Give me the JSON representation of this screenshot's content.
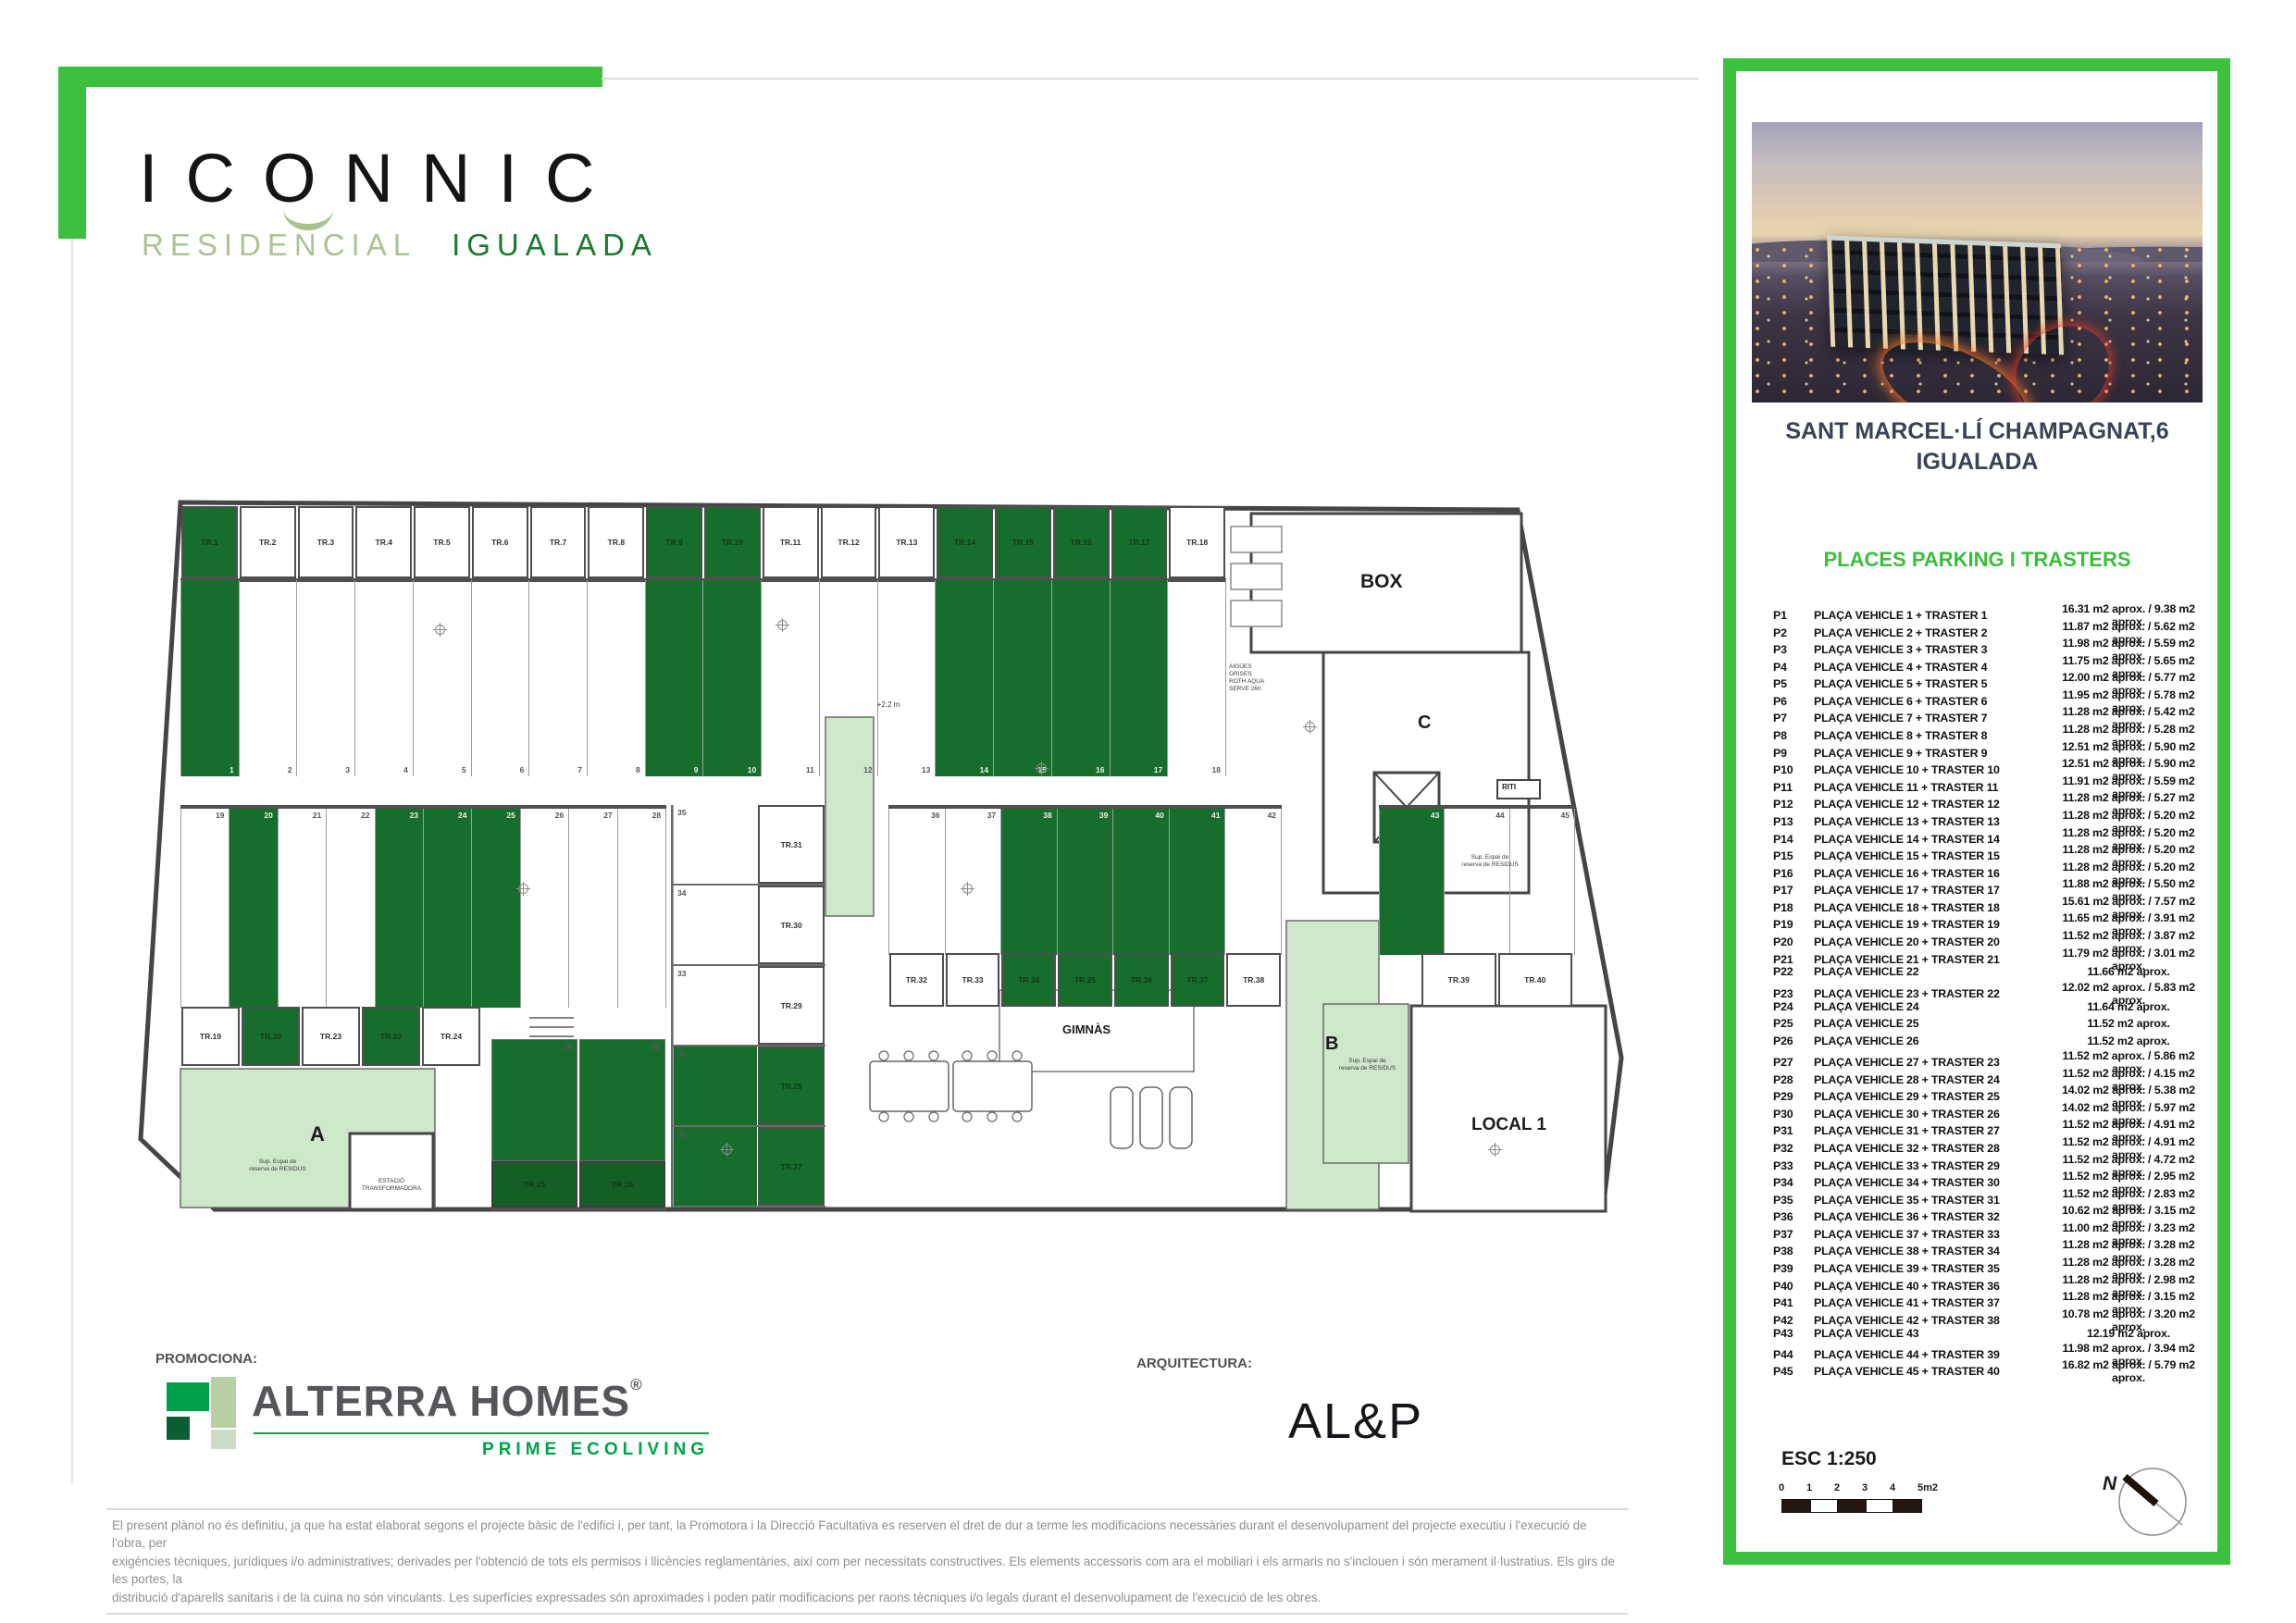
{
  "brand": {
    "name": "ICONNIC",
    "tagline_left": "RESIDENCIAL",
    "tagline_right": "IGUALADA"
  },
  "promoter": {
    "label": "PROMOCIONA:",
    "name": "ALTERRA HOMES",
    "reg": "®",
    "tagline": "PRIME ECOLIVING"
  },
  "architect": {
    "label": "ARQUITECTURA:",
    "name": "AL&P"
  },
  "panel": {
    "address_line1": "SANT MARCEL·LÍ CHAMPAGNAT,6",
    "address_line2": "IGUALADA",
    "list_title": "PLACES PARKING I TRASTERS",
    "scale_label": "ESC 1:250",
    "scale_ticks": [
      "0",
      "1",
      "2",
      "3",
      "4",
      "5m2"
    ],
    "north_label": "N",
    "spots": [
      {
        "ref": "P1",
        "desc": "PLAÇA VEHICLE 1 + TRASTER 1",
        "area": "16.31 m2 aprox. / 9.38 m2 aprox."
      },
      {
        "ref": "P2",
        "desc": "PLAÇA VEHICLE 2 + TRASTER 2",
        "area": "11.87 m2 aprox. / 5.62 m2 aprox."
      },
      {
        "ref": "P3",
        "desc": "PLAÇA VEHICLE 3 + TRASTER 3",
        "area": "11.98 m2 aprox. / 5.59 m2 aprox."
      },
      {
        "ref": "P4",
        "desc": "PLAÇA VEHICLE 4 + TRASTER 4",
        "area": "11.75 m2 aprox. / 5.65 m2 aprox."
      },
      {
        "ref": "P5",
        "desc": "PLAÇA VEHICLE 5 + TRASTER 5",
        "area": "12.00 m2 aprox. / 5.77 m2 aprox."
      },
      {
        "ref": "P6",
        "desc": "PLAÇA VEHICLE 6 + TRASTER 6",
        "area": "11.95 m2 aprox. / 5.78 m2 aprox."
      },
      {
        "ref": "P7",
        "desc": "PLAÇA VEHICLE 7 + TRASTER 7",
        "area": "11.28 m2 aprox. / 5.42 m2 aprox."
      },
      {
        "ref": "P8",
        "desc": "PLAÇA VEHICLE 8 + TRASTER 8",
        "area": "11.28 m2 aprox. / 5.28 m2 aprox."
      },
      {
        "ref": "P9",
        "desc": "PLAÇA VEHICLE 9 + TRASTER 9",
        "area": "12.51 m2 aprox. / 5.90 m2 aprox."
      },
      {
        "ref": "P10",
        "desc": "PLAÇA VEHICLE 10 + TRASTER 10",
        "area": "12.51 m2 aprox. / 5.90 m2 aprox."
      },
      {
        "ref": "P11",
        "desc": "PLAÇA VEHICLE 11 + TRASTER 11",
        "area": "11.91 m2 aprox. / 5.59 m2 aprox."
      },
      {
        "ref": "P12",
        "desc": "PLAÇA VEHICLE 12 + TRASTER 12",
        "area": "11.28 m2 aprox. / 5.27 m2 aprox."
      },
      {
        "ref": "P13",
        "desc": "PLAÇA VEHICLE 13 + TRASTER 13",
        "area": "11.28 m2 aprox. / 5.20 m2 aprox."
      },
      {
        "ref": "P14",
        "desc": "PLAÇA VEHICLE 14 + TRASTER 14",
        "area": "11.28 m2 aprox. / 5.20 m2 aprox."
      },
      {
        "ref": "P15",
        "desc": "PLAÇA VEHICLE 15 + TRASTER 15",
        "area": "11.28 m2 aprox. / 5.20 m2 aprox."
      },
      {
        "ref": "P16",
        "desc": "PLAÇA VEHICLE 16 + TRASTER 16",
        "area": "11.28 m2 aprox. / 5.20 m2 aprox."
      },
      {
        "ref": "P17",
        "desc": "PLAÇA VEHICLE 17 + TRASTER 17",
        "area": "11.88 m2 aprox. / 5.50 m2 aprox."
      },
      {
        "ref": "P18",
        "desc": "PLAÇA VEHICLE 18 + TRASTER 18",
        "area": "15.61 m2 aprox. / 7.57 m2 aprox."
      },
      {
        "ref": "P19",
        "desc": "PLAÇA VEHICLE 19 + TRASTER 19",
        "area": "11.65 m2 aprox. / 3.91 m2 aprox."
      },
      {
        "ref": "P20",
        "desc": "PLAÇA VEHICLE 20 + TRASTER 20",
        "area": "11.52 m2 aprox. / 3.87 m2 aprox."
      },
      {
        "ref": "P21",
        "desc": "PLAÇA VEHICLE 21 + TRASTER 21",
        "area": "11.79 m2 aprox. / 3.01 m2 aprox."
      },
      {
        "ref": "P22",
        "desc": "PLAÇA VEHICLE 22",
        "area": "11.66 m2 aprox."
      },
      {
        "ref": "P23",
        "desc": "PLAÇA VEHICLE 23 + TRASTER 22",
        "area": "12.02 m2 aprox. / 5.83 m2 aprox."
      },
      {
        "ref": "P24",
        "desc": "PLAÇA VEHICLE 24",
        "area": "11.64 m2 aprox."
      },
      {
        "ref": "P25",
        "desc": "PLAÇA VEHICLE 25",
        "area": "11.52 m2 aprox."
      },
      {
        "ref": "P26",
        "desc": "PLAÇA VEHICLE 26",
        "area": "11.52 m2 aprox."
      },
      {
        "ref": "P27",
        "desc": "PLAÇA VEHICLE 27 + TRASTER 23",
        "area": "11.52 m2 aprox. / 5.86 m2 aprox."
      },
      {
        "ref": "P28",
        "desc": "PLAÇA VEHICLE 28 + TRASTER 24",
        "area": "11.52 m2 aprox. / 4.15 m2 aprox."
      },
      {
        "ref": "P29",
        "desc": "PLAÇA VEHICLE 29 + TRASTER 25",
        "area": "14.02 m2 aprox. / 5.38 m2 aprox."
      },
      {
        "ref": "P30",
        "desc": "PLAÇA VEHICLE 30 + TRASTER 26",
        "area": "14.02 m2 aprox. / 5.97 m2 aprox."
      },
      {
        "ref": "P31",
        "desc": "PLAÇA VEHICLE 31 + TRASTER 27",
        "area": "11.52 m2 aprox. / 4.91 m2 aprox."
      },
      {
        "ref": "P32",
        "desc": "PLAÇA VEHICLE 32 + TRASTER 28",
        "area": "11.52 m2 aprox. / 4.91 m2 aprox."
      },
      {
        "ref": "P33",
        "desc": "PLAÇA VEHICLE 33 + TRASTER 29",
        "area": "11.52 m2 aprox. / 4.72 m2 aprox."
      },
      {
        "ref": "P34",
        "desc": "PLAÇA VEHICLE 34 + TRASTER 30",
        "area": "11.52 m2 aprox. / 2.95 m2 aprox."
      },
      {
        "ref": "P35",
        "desc": "PLAÇA VEHICLE 35 + TRASTER 31",
        "area": "11.52 m2 aprox. / 2.83 m2 aprox."
      },
      {
        "ref": "P36",
        "desc": "PLAÇA VEHICLE 36 + TRASTER 32",
        "area": "10.62 m2 aprox. / 3.15 m2 aprox."
      },
      {
        "ref": "P37",
        "desc": "PLAÇA VEHICLE 37 + TRASTER 33",
        "area": "11.00 m2 aprox. / 3.23 m2 aprox."
      },
      {
        "ref": "P38",
        "desc": "PLAÇA VEHICLE 38 + TRASTER 34",
        "area": "11.28 m2 aprox. / 3.28 m2 aprox."
      },
      {
        "ref": "P39",
        "desc": "PLAÇA VEHICLE 39 + TRASTER 35",
        "area": "11.28 m2 aprox. / 3.28 m2 aprox."
      },
      {
        "ref": "P40",
        "desc": "PLAÇA VEHICLE 40 + TRASTER 36",
        "area": "11.28 m2 aprox. / 2.98 m2 aprox."
      },
      {
        "ref": "P41",
        "desc": "PLAÇA VEHICLE 41 + TRASTER 37",
        "area": "11.28 m2 aprox. / 3.15 m2 aprox."
      },
      {
        "ref": "P42",
        "desc": "PLAÇA VEHICLE 42 + TRASTER 38",
        "area": "10.78 m2 aprox. / 3.20 m2 aprox."
      },
      {
        "ref": "P43",
        "desc": "PLAÇA VEHICLE 43",
        "area": "12.19 m2 aprox."
      },
      {
        "ref": "P44",
        "desc": "PLAÇA VEHICLE 44 + TRASTER 39",
        "area": "11.98 m2 aprox. / 3.94 m2 aprox."
      },
      {
        "ref": "P45",
        "desc": "PLAÇA VEHICLE 45 + TRASTER 40",
        "area": "16.82 m2 aprox. / 5.79 m2 aprox."
      }
    ]
  },
  "plan": {
    "rooms": {
      "box": "BOX",
      "gimnas": "GIMNÀS",
      "local": "LOCAL 1",
      "core_a": "A",
      "core_b": "B",
      "core_c": "C",
      "riti": "RITI",
      "estacio": "ESTACIÓ\nTRANSFORMADORA",
      "ramp": "+2.2 m",
      "aigues": "AIGÜES\nGRISES\nROTH AQUA\nSERVE 260",
      "reserva_a": "Sup. Espai de\nreserva de RESIDUS",
      "reserva_b": "Sup. Espai de\nreserva de RESIDUS",
      "reserva_c": "Sup. Espai de\nreserva de RESIDUS"
    },
    "trasters_top": [
      {
        "label": "TR.1",
        "state": "sold"
      },
      {
        "label": "TR.2",
        "state": "free"
      },
      {
        "label": "TR.3",
        "state": "free"
      },
      {
        "label": "TR.4",
        "state": "free"
      },
      {
        "label": "TR.5",
        "state": "free"
      },
      {
        "label": "TR.6",
        "state": "free"
      },
      {
        "label": "TR.7",
        "state": "free"
      },
      {
        "label": "TR.8",
        "state": "free"
      },
      {
        "label": "TR.9",
        "state": "sold"
      },
      {
        "label": "TR.10",
        "state": "sold"
      },
      {
        "label": "TR.11",
        "state": "free"
      },
      {
        "label": "TR.12",
        "state": "free"
      },
      {
        "label": "TR.13",
        "state": "free"
      },
      {
        "label": "TR.14",
        "state": "sold"
      },
      {
        "label": "TR.15",
        "state": "sold"
      },
      {
        "label": "TR.16",
        "state": "sold"
      },
      {
        "label": "TR.17",
        "state": "sold"
      },
      {
        "label": "TR.18",
        "state": "free"
      }
    ],
    "stalls_top": [
      {
        "num": "1",
        "state": "sold"
      },
      {
        "num": "2",
        "state": "free"
      },
      {
        "num": "3",
        "state": "free"
      },
      {
        "num": "4",
        "state": "free"
      },
      {
        "num": "5",
        "state": "free"
      },
      {
        "num": "6",
        "state": "free"
      },
      {
        "num": "7",
        "state": "free"
      },
      {
        "num": "8",
        "state": "free"
      },
      {
        "num": "9",
        "state": "sold"
      },
      {
        "num": "10",
        "state": "sold"
      },
      {
        "num": "11",
        "state": "free"
      },
      {
        "num": "12",
        "state": "free"
      },
      {
        "num": "13",
        "state": "free"
      },
      {
        "num": "14",
        "state": "sold"
      },
      {
        "num": "15",
        "state": "sold"
      },
      {
        "num": "16",
        "state": "sold"
      },
      {
        "num": "17",
        "state": "sold"
      },
      {
        "num": "18",
        "state": "free"
      }
    ],
    "stalls_mid_left": [
      {
        "num": "19",
        "state": "free"
      },
      {
        "num": "20",
        "state": "sold"
      },
      {
        "num": "21",
        "state": "free"
      },
      {
        "num": "22",
        "state": "free"
      },
      {
        "num": "23",
        "state": "sold"
      },
      {
        "num": "24",
        "state": "sold"
      },
      {
        "num": "25",
        "state": "sold"
      },
      {
        "num": "26",
        "state": "free"
      },
      {
        "num": "27",
        "state": "free"
      },
      {
        "num": "28",
        "state": "free"
      }
    ],
    "trasters_mid_left": [
      {
        "label": "TR.19",
        "state": "free"
      },
      {
        "label": "TR.20",
        "state": "sold"
      },
      {
        "label": "TR.23",
        "state": "free"
      },
      {
        "label": "TR.22",
        "state": "sold"
      },
      {
        "label": "TR.24",
        "state": "free"
      }
    ],
    "stack_rows": [
      {
        "num": "35",
        "state": "free",
        "tr": "TR.31",
        "tr_state": "free"
      },
      {
        "num": "34",
        "state": "free",
        "tr": "TR.30",
        "tr_state": "free"
      },
      {
        "num": "33",
        "state": "free",
        "tr": "TR.29",
        "tr_state": "free"
      },
      {
        "num": "32",
        "state": "sold",
        "tr": "TR.28",
        "tr_state": "sold"
      },
      {
        "num": "31",
        "state": "sold",
        "tr": "TR.27",
        "tr_state": "sold"
      }
    ],
    "pair_bottom": [
      {
        "num": "29",
        "state": "sold",
        "tr": "TR.25",
        "tr_state": "sold"
      },
      {
        "num": "30",
        "state": "sold",
        "tr": "TR.26",
        "tr_state": "sold"
      }
    ],
    "stalls_mid_right": [
      {
        "num": "36",
        "state": "free"
      },
      {
        "num": "37",
        "state": "free"
      },
      {
        "num": "38",
        "state": "sold"
      },
      {
        "num": "39",
        "state": "sold"
      },
      {
        "num": "40",
        "state": "sold"
      },
      {
        "num": "41",
        "state": "sold"
      },
      {
        "num": "42",
        "state": "free"
      }
    ],
    "stalls_far_right": [
      {
        "num": "43",
        "state": "sold"
      },
      {
        "num": "44",
        "state": "free"
      },
      {
        "num": "45",
        "state": "free"
      }
    ],
    "trasters_mid_right": [
      {
        "label": "TR.32",
        "state": "free"
      },
      {
        "label": "TR.33",
        "state": "free"
      },
      {
        "label": "TR.34",
        "state": "sold"
      },
      {
        "label": "TR.35",
        "state": "sold"
      },
      {
        "label": "TR.36",
        "state": "sold"
      },
      {
        "label": "TR.37",
        "state": "sold"
      },
      {
        "label": "TR.38",
        "state": "free"
      }
    ],
    "trasters_right2": [
      {
        "label": "TR.39",
        "state": "free"
      },
      {
        "label": "TR.40",
        "state": "free"
      }
    ]
  },
  "disclaimer": {
    "line1": "El present plànol no és definitiu, ja que ha estat elaborat segons el projecte bàsic de l'edifici i, per tant, la Promotora i la Direcció Facultativa es reserven el dret de dur a terme les modificacions necessàries durant el desenvolupament del projecte executiu i l'execució de l'obra, per",
    "line2": "exigències tècniques, jurídiques i/o administratives; derivades per l'obtenció de tots els permisos i llicències reglamentàries, així com per necessitats constructives. Els elements accessoris com ara el mobiliari i els armaris no s'inclouen i són merament il·lustratius. Els girs de les portes, la",
    "line3": "distribució d'aparells sanitaris i de la cuina no són vinculants. Les superfícies expressades són aproximades i poden patir modificacions per raons tècniques i/o legals durant el desenvolupament de l'execució de les obres."
  },
  "colors": {
    "accent_green": "#3CC13F",
    "sold_green": "#176E2C",
    "light_green": "#CFE8CB",
    "brand_dark_green": "#1C7A2F",
    "brand_pale_green": "#AEC394",
    "heading_navy": "#3A4254",
    "logo_gray": "#55565A",
    "eco_green": "#00A14B"
  }
}
